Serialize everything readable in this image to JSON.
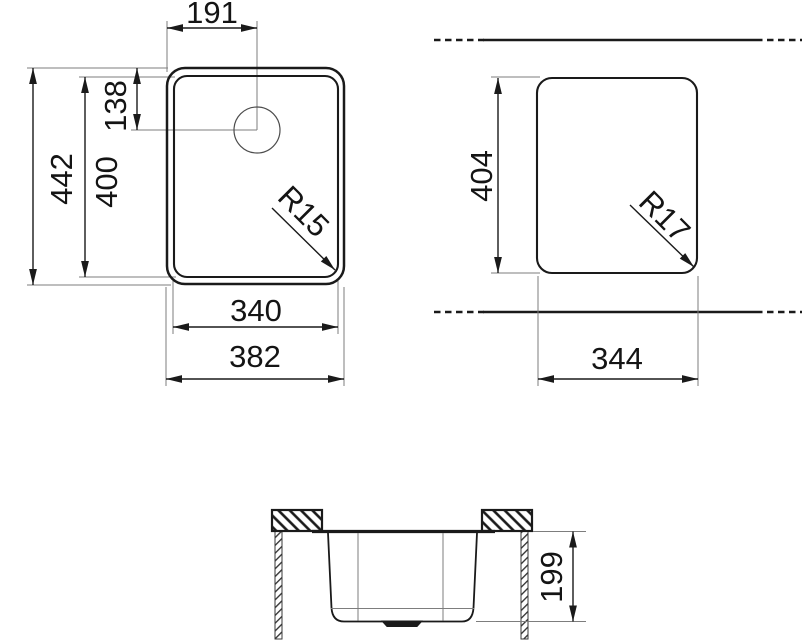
{
  "drawing_type": "sink-technical-drawing",
  "colors": {
    "line": "#1a1a1a",
    "thin_line": "#7d7d7d",
    "background": "#ffffff"
  },
  "top_view": {
    "drain_offset_x": "191",
    "drain_offset_y": "138",
    "overall_height": "442",
    "bowl_height": "400",
    "corner_radius": "R15",
    "bowl_width": "340",
    "overall_width": "382"
  },
  "cutout_view": {
    "cutout_height": "404",
    "corner_radius": "R17",
    "cutout_width": "344"
  },
  "section_view": {
    "bowl_depth": "199"
  }
}
